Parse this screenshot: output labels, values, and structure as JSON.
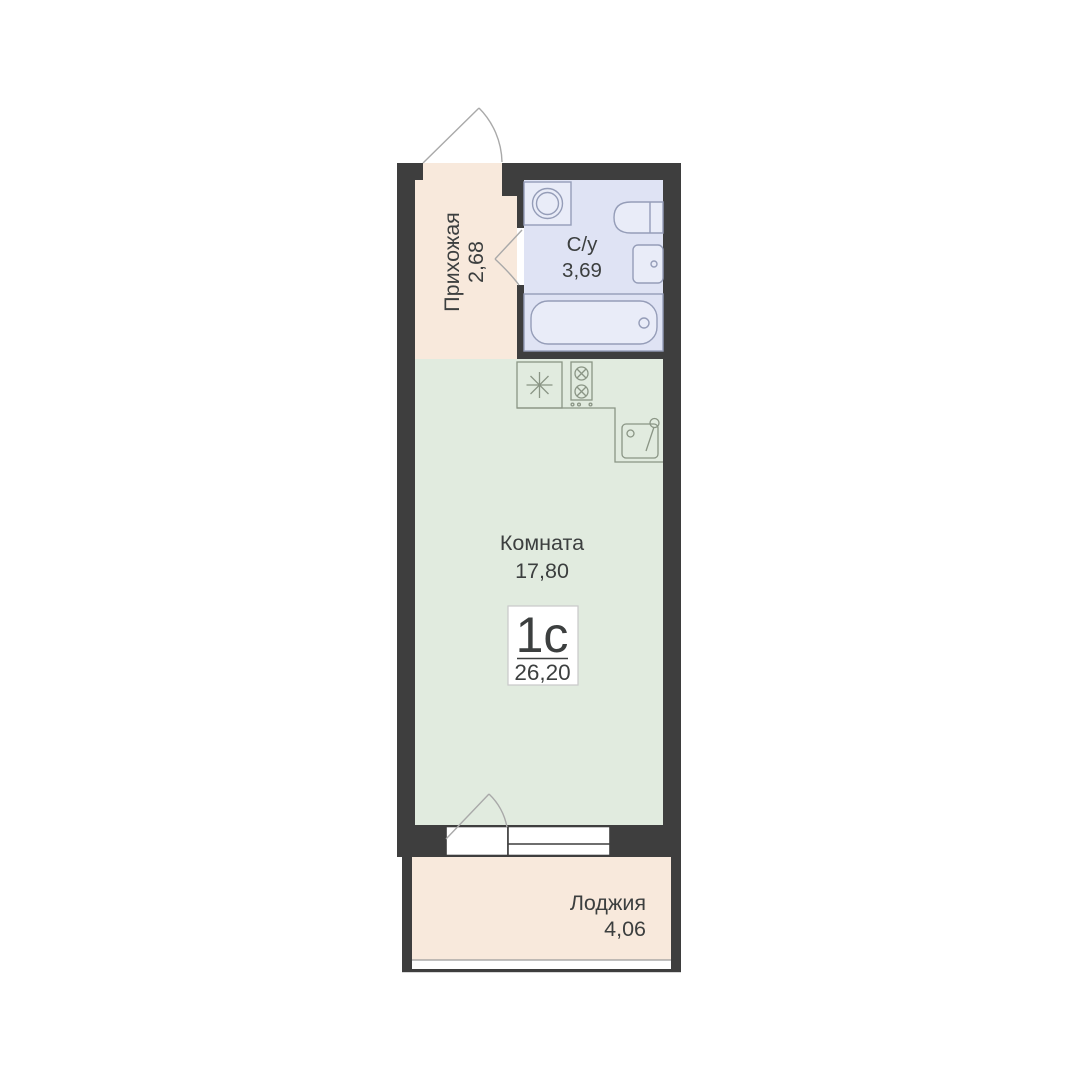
{
  "unit": {
    "type_label": "1с",
    "total_area": "26,20"
  },
  "rooms": {
    "hallway": {
      "name": "Прихожая",
      "area": "2,68"
    },
    "bathroom": {
      "name": "С/у",
      "area": "3,69"
    },
    "living_room": {
      "name": "Комната",
      "area": "17,80"
    },
    "loggia": {
      "name": "Лоджия",
      "area": "4,06"
    }
  },
  "colors": {
    "wall": "#3e3e3e",
    "hallway_fill": "#f8e9dc",
    "bathroom_fill": "#dfe3f4",
    "room_fill": "#e1ebdf",
    "loggia_fill": "#f8e9dc",
    "text": "#3c3f3f",
    "badge_background": "#ffffff",
    "badge_border": "#c9c9c9"
  },
  "icons": {
    "washing_machine": "washing-machine-icon",
    "toilet": "toilet-icon",
    "bathroom_sink": "bathroom-sink-icon",
    "bathtub": "bathtub-icon",
    "fridge_snowflake": "fridge-icon",
    "stove": "stove-icon",
    "kitchen_sink": "kitchen-sink-icon",
    "entrance_door": "entrance-door-swing-icon",
    "bathroom_door": "bathroom-door-swing-icon",
    "balcony_door": "balcony-door-swing-icon",
    "window": "window-icon"
  }
}
